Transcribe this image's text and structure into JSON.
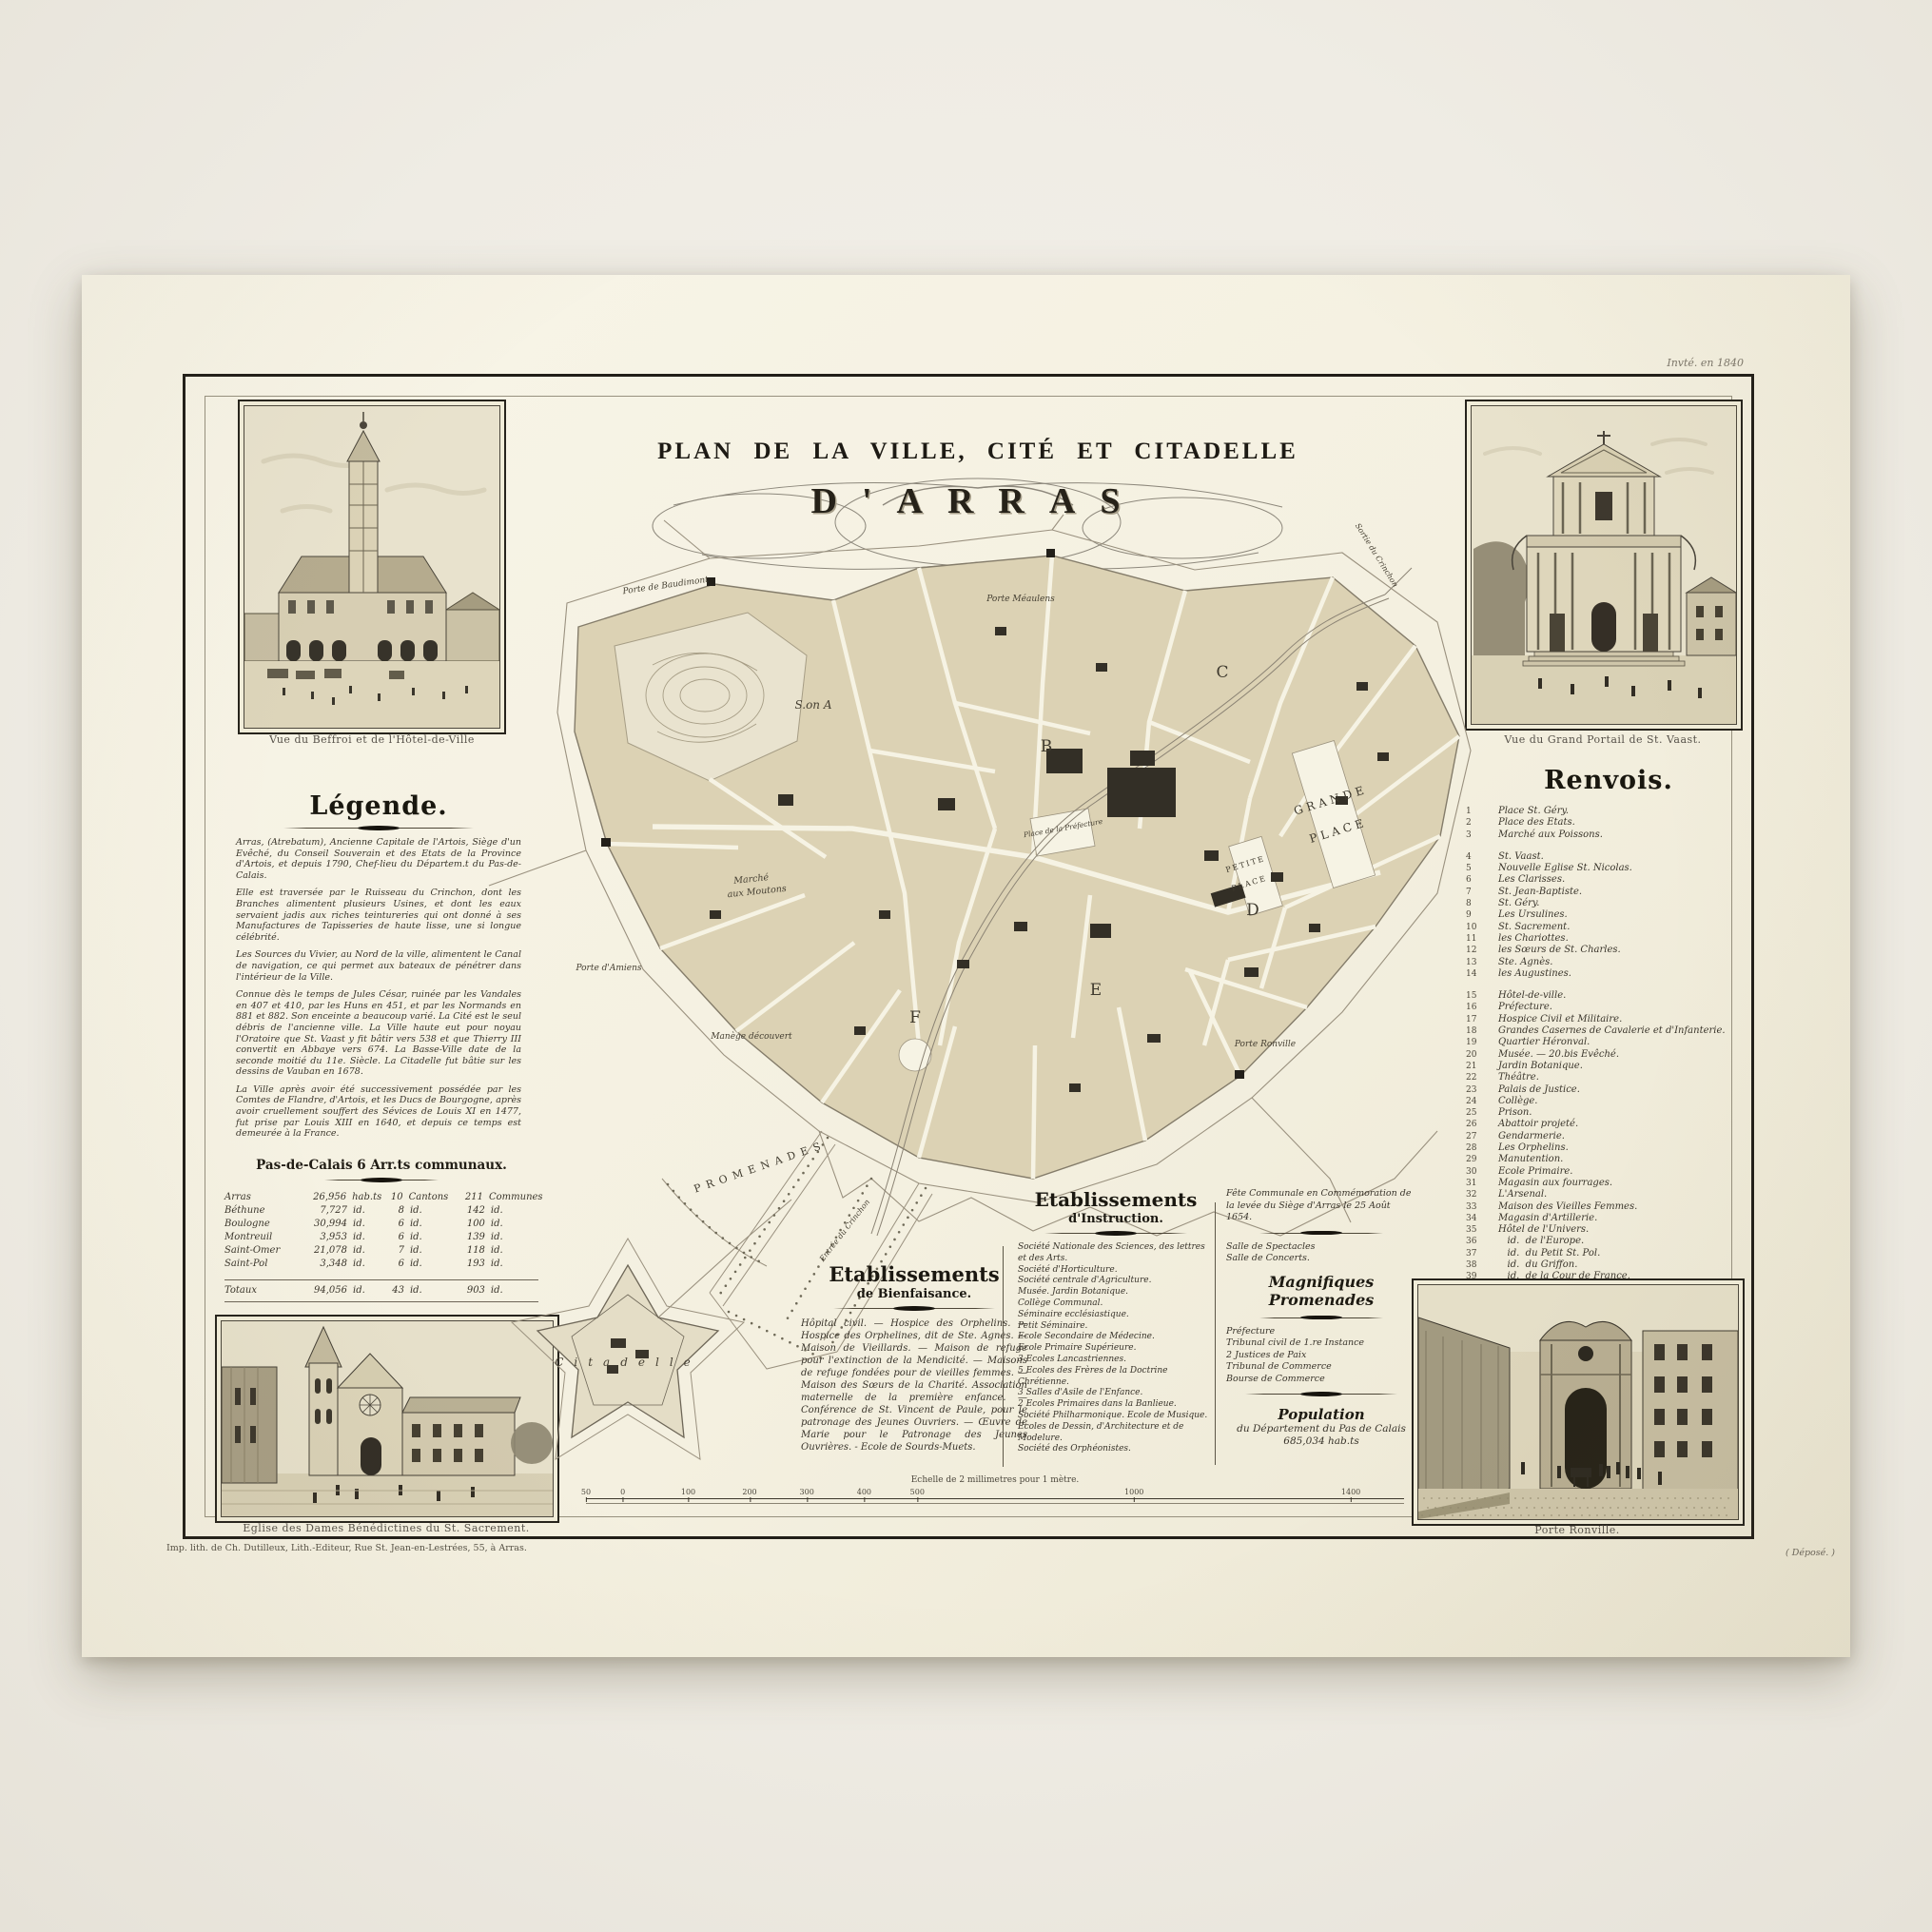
{
  "poster": {
    "corner_note": "Invté. en 1840",
    "imprint": "Imp. lith. de Ch. Dutilleux, Lith.-Editeur, Rue St. Jean-en-Lestrées, 55, à Arras.",
    "depose": "( Déposé. )"
  },
  "title": {
    "line1": "PLAN DE LA VILLE, CITÉ ET CITADELLE",
    "line2": "D'ARRAS"
  },
  "vignettes": {
    "belfry_caption": "Vue du Beffroi et de l'Hôtel-de-Ville",
    "stvaast_caption": "Vue du Grand Portail de St. Vaast.",
    "benedictines_caption": "Eglise des Dames Bénédictines du St. Sacrement.",
    "ronville_caption": "Porte Ronville."
  },
  "legende": {
    "heading": "Légende.",
    "paragraphs": [
      "Arras, (Atrebatum), Ancienne Capitale de l'Artois, Siège d'un Evêché, du Conseil Souverain et des Etats de la Province d'Artois, et depuis 1790, Chef-lieu du Départem.t du Pas-de-Calais.",
      "Elle est traversée par le Ruisseau du Crinchon, dont les Branches alimentent plusieurs Usines, et dont les eaux servaient jadis aux riches teintureries qui ont donné à ses Manufactures de Tapisseries de haute lisse, une si longue célébrité.",
      "Les Sources du Vivier, au Nord de la ville, alimentent le Canal de navigation, ce qui permet aux bateaux de pénétrer dans l'intérieur de la Ville.",
      "Connue dès le temps de Jules César, ruinée par les Vandales en 407 et 410, par les Huns en 451, et par les Normands en 881 et 882. Son enceinte a beaucoup varié. La Cité est le seul débris de l'ancienne ville. La Ville haute eut pour noyau l'Oratoire que St. Vaast y fit bâtir vers 538 et que Thierry III convertit en Abbaye vers 674. La Basse-Ville date de la seconde moitié du 11e. Siècle. La Citadelle fut bâtie sur les dessins de Vauban en 1678.",
      "La Ville après avoir été successivement possédée par les Comtes de Flandre, d'Artois, et les Ducs de Bourgogne, après avoir cruellement souffert des Sévices de Louis XI en 1477, fut prise par Louis XIII en 1640, et depuis ce temps est demeurée à la France."
    ],
    "table": {
      "heading": "Pas-de-Calais   6 Arr.ts communaux.",
      "rows": [
        {
          "name": "Arras",
          "pop": "26,956",
          "pu": "hab.ts",
          "cant": "10",
          "cu": "Cantons",
          "comm": "211",
          "cmu": "Communes"
        },
        {
          "name": "Béthune",
          "pop": "7,727",
          "pu": "id.",
          "cant": "8",
          "cu": "id.",
          "comm": "142",
          "cmu": "id."
        },
        {
          "name": "Boulogne",
          "pop": "30,994",
          "pu": "id.",
          "cant": "6",
          "cu": "id.",
          "comm": "100",
          "cmu": "id."
        },
        {
          "name": "Montreuil",
          "pop": "3,953",
          "pu": "id.",
          "cant": "6",
          "cu": "id.",
          "comm": "139",
          "cmu": "id."
        },
        {
          "name": "Saint-Omer",
          "pop": "21,078",
          "pu": "id.",
          "cant": "7",
          "cu": "id.",
          "comm": "118",
          "cmu": "id."
        },
        {
          "name": "Saint-Pol",
          "pop": "3,348",
          "pu": "id.",
          "cant": "6",
          "cu": "id.",
          "comm": "193",
          "cmu": "id."
        }
      ],
      "total": {
        "name": "Totaux",
        "pop": "94,056",
        "pu": "id.",
        "cant": "43",
        "cu": "id.",
        "comm": "903",
        "cmu": "id."
      }
    }
  },
  "renvois": {
    "heading": "Renvois.",
    "group1": [
      {
        "num": "1",
        "label": "Place St. Géry."
      },
      {
        "num": "2",
        "label": "Place des Etats."
      },
      {
        "num": "3",
        "label": "Marché aux Poissons."
      }
    ],
    "group2": [
      {
        "num": "4",
        "label": "St. Vaast."
      },
      {
        "num": "5",
        "label": "Nouvelle Eglise St. Nicolas."
      },
      {
        "num": "6",
        "label": "Les Clarisses."
      },
      {
        "num": "7",
        "label": "St. Jean-Baptiste."
      },
      {
        "num": "8",
        "label": "St. Géry."
      },
      {
        "num": "9",
        "label": "Les Ursulines."
      },
      {
        "num": "10",
        "label": "St. Sacrement."
      },
      {
        "num": "11",
        "label": "les Chariottes."
      },
      {
        "num": "12",
        "label": "les Sœurs de St. Charles."
      },
      {
        "num": "13",
        "label": "Ste. Agnès."
      },
      {
        "num": "14",
        "label": "les Augustines."
      }
    ],
    "group3": [
      {
        "num": "15",
        "label": "Hôtel-de-ville."
      },
      {
        "num": "16",
        "label": "Préfecture."
      },
      {
        "num": "17",
        "label": "Hospice Civil et Militaire."
      },
      {
        "num": "18",
        "label": "Grandes Casernes de Cavalerie et d'Infanterie."
      },
      {
        "num": "19",
        "label": "Quartier Héronval."
      },
      {
        "num": "20",
        "label": "Musée. — 20.bis Evêché."
      },
      {
        "num": "21",
        "label": "Jardin Botanique."
      },
      {
        "num": "22",
        "label": "Théâtre."
      },
      {
        "num": "23",
        "label": "Palais de Justice."
      },
      {
        "num": "24",
        "label": "Collège."
      },
      {
        "num": "25",
        "label": "Prison."
      },
      {
        "num": "26",
        "label": "Abattoir projeté."
      },
      {
        "num": "27",
        "label": "Gendarmerie."
      },
      {
        "num": "28",
        "label": "Les Orphelins."
      },
      {
        "num": "29",
        "label": "Manutention."
      },
      {
        "num": "30",
        "label": "Ecole Primaire."
      },
      {
        "num": "31",
        "label": "Magasin aux fourrages."
      },
      {
        "num": "32",
        "label": "L'Arsenal."
      },
      {
        "num": "33",
        "label": "Maison des Vieilles Femmes."
      },
      {
        "num": "34",
        "label": "Magasin d'Artillerie."
      },
      {
        "num": "35",
        "label": "Hôtel de l'Univers."
      },
      {
        "num": "36",
        "label": "   id.  de l'Europe."
      },
      {
        "num": "37",
        "label": "   id.  du Petit St. Pol."
      },
      {
        "num": "38",
        "label": "   id.  du Griffon."
      },
      {
        "num": "39",
        "label": "   id.  de la Cour de France."
      },
      {
        "num": "40",
        "label": "Magasin des Vivres."
      },
      {
        "num": "41",
        "label": "Ecole des Sourds-Muets."
      },
      {
        "num": "42",
        "label": "Café des Allées."
      }
    ]
  },
  "bienfaisance": {
    "heading1": "Etablissements",
    "heading2": "de Bienfaisance.",
    "body": "Hôpital civil. — Hospice des Orphelins. — Hospice des Orphelines, dit de Ste. Agnès. — Maison de Vieillards. — Maison de refuge pour l'extinction de la Mendicité. — Maisons de refuge fondées pour de vieilles femmes. — Maison des Sœurs de la Charité. Association maternelle de la première enfance. — Conférence de St. Vincent de Paule, pour le patronage des Jeunes Ouvriers. — Œuvre de Marie pour le Patronage des Jeunes Ouvrières. - Ecole de Sourds-Muets."
  },
  "instruction": {
    "heading1": "Etablissements",
    "heading2": "d'Instruction.",
    "items": [
      "Société Nationale des Sciences, des lettres et des Arts.",
      "Société d'Horticulture.",
      "Société centrale d'Agriculture.",
      "Musée. Jardin Botanique.",
      "Collège Communal.",
      "Séminaire ecclésiastique.",
      "Petit Séminaire.",
      "Ecole Secondaire de Médecine.",
      "Ecole Primaire Supérieure.",
      "3 Ecoles Lancastriennes.",
      "5 Ecoles des Frères de la Doctrine Chrétienne.",
      "3 Salles d'Asile de l'Enfance.",
      "2 Ecoles Primaires dans la Banlieue.",
      "Société Philharmonique. Ecole de Musique.",
      "Ecoles de Dessin, d'Architecture et de Modelure.",
      "Société des Orphéonistes."
    ]
  },
  "fete": {
    "lines": [
      "Fête Communale en Commémoration de",
      "la levée du Siège d'Arras le 25 Août 1654."
    ]
  },
  "salles": [
    "Salle de Spectacles",
    "Salle de Concerts."
  ],
  "promenades_heading": "Magnifiques Promenades",
  "justice": [
    "Préfecture",
    "Tribunal civil de 1.re Instance",
    "2 Justices de Paix",
    "Tribunal de Commerce",
    "Bourse de Commerce"
  ],
  "population": {
    "line1": "Population",
    "line2": "du Département du Pas de Calais",
    "line3": "685,034 hab.ts"
  },
  "scale": {
    "caption": "Echelle de 2 millimetres pour 1 mètre.",
    "ticks": [
      "50",
      "0",
      "100",
      "200",
      "300",
      "400",
      "500",
      "1000",
      "1400"
    ]
  },
  "map": {
    "labels": {
      "porte_baudimont": "Porte de Baudimont",
      "porte_meaulens": "Porte Méaulens",
      "sortie_crinchon": "Sortie du Crinchon",
      "entree_crinchon": "Entrée du Crinchon",
      "section_a": "S.on A",
      "section_b": "B",
      "section_c": "C",
      "section_d": "D",
      "section_e": "E",
      "section_f": "F",
      "grande_1": "GRANDE",
      "grande_2": "PLACE",
      "petite_1": "PETITE",
      "petite_2": "PLACE",
      "place_prefecture": "Place de la Préfecture",
      "marche_1": "Marché",
      "marche_2": "aux Moutons",
      "porte_amiens": "Porte d'Amiens",
      "manege": "Manège découvert",
      "promenades": "PROMENADES",
      "porte_ronville": "Porte Ronville",
      "citadelle": "Citadelle"
    }
  }
}
